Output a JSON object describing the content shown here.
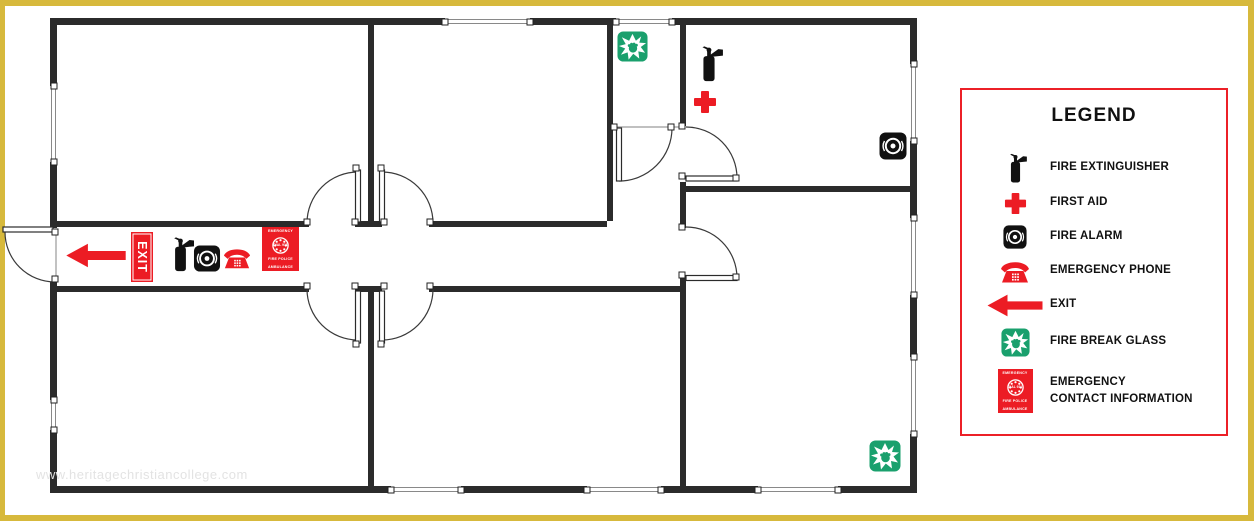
{
  "watermark": "www.heritagechristiancollege.com",
  "plan": {
    "exit_sign": "EXIT",
    "symbols": [
      "exit-arrow",
      "exit-sign",
      "fire-extinguisher",
      "fire-alarm",
      "emergency-phone",
      "emergency-contact",
      "first-aid",
      "fire-break-glass"
    ]
  },
  "contact_sign": {
    "line1": "EMERGENCY",
    "dial": "DIAL 911",
    "line3": "FIRE POLICE",
    "line4": "AMBULANCE"
  },
  "legend": {
    "title": "LEGEND",
    "items": [
      {
        "icon": "fire-extinguisher-icon",
        "label": "FIRE EXTINGUISHER"
      },
      {
        "icon": "first-aid-icon",
        "label": "FIRST AID"
      },
      {
        "icon": "fire-alarm-icon",
        "label": "FIRE ALARM"
      },
      {
        "icon": "emergency-phone-icon",
        "label": "EMERGENCY PHONE"
      },
      {
        "icon": "exit-arrow-icon",
        "label": "EXIT"
      },
      {
        "icon": "fire-break-glass-icon",
        "label": "FIRE BREAK GLASS"
      },
      {
        "icon": "emergency-contact-icon",
        "label": "EMERGENCY",
        "label2": "CONTACT INFORMATION"
      }
    ]
  },
  "colors": {
    "accent_red": "#ec1c24",
    "green": "#1aa06d",
    "frame_yellow": "#d7b93c",
    "wall": "#2b2b2b"
  }
}
